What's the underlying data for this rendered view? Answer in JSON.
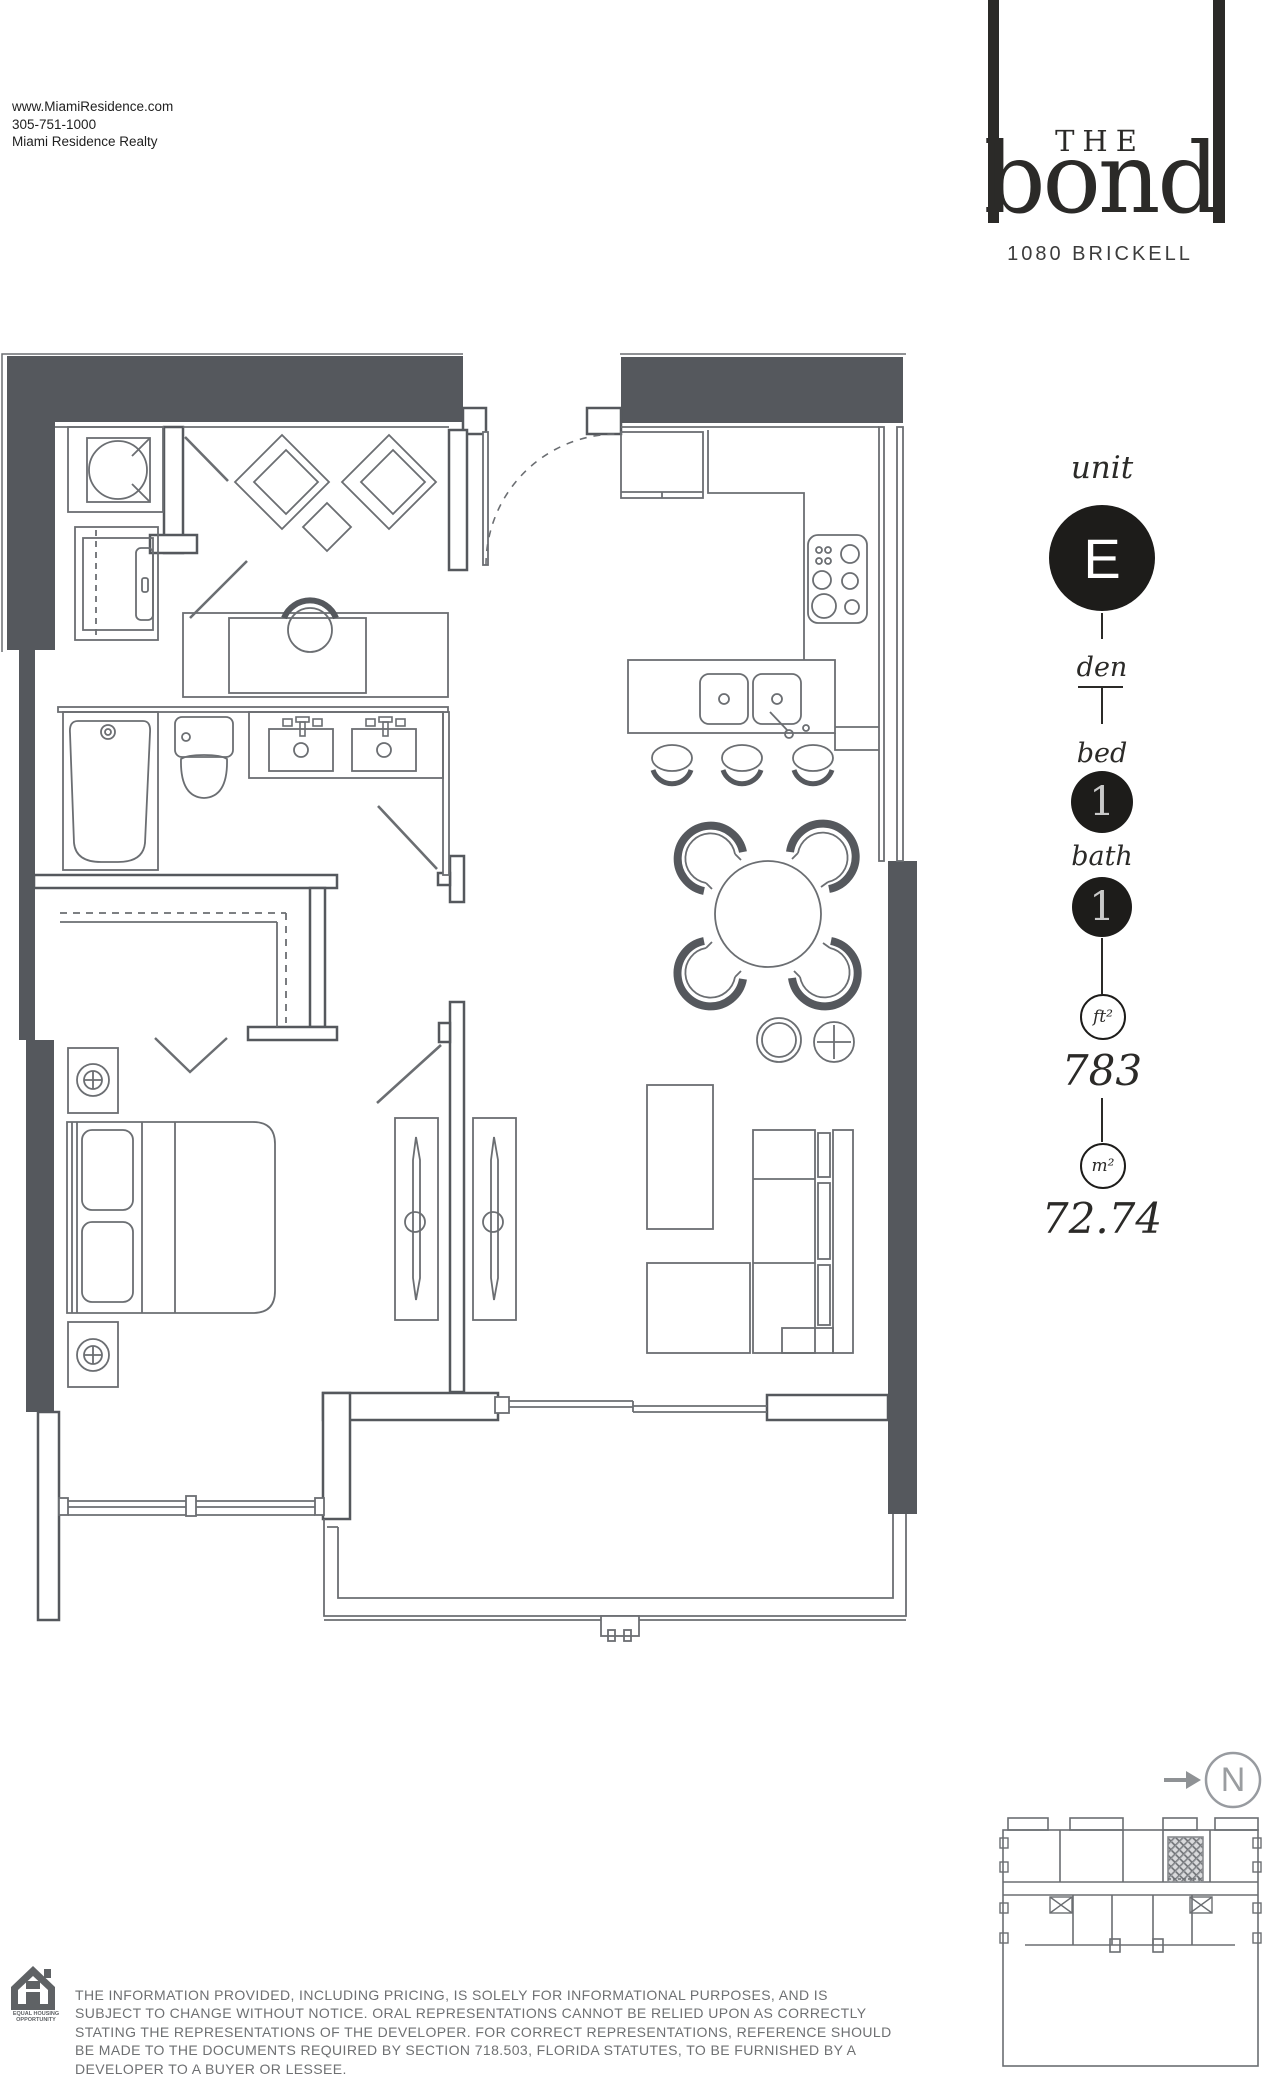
{
  "header": {
    "contact": "www.MiamiResidence.com\n305-751-1000\nMiami Residence Realty",
    "brand": {
      "the": "THE",
      "name": "bond",
      "address": "1080 BRICKELL"
    }
  },
  "unit_panel": {
    "unit_label": "unit",
    "unit_value": "E",
    "den_label": "den",
    "bed_label": "bed",
    "bed_value": "1",
    "bath_label": "bath",
    "bath_value": "1",
    "sqft_label": "ft²",
    "sqft_value": "783",
    "sqm_label": "m²",
    "sqm_value": "72.74",
    "accent_color": "#1d1c1a"
  },
  "compass": {
    "label": "N"
  },
  "floor_plan": {
    "wall_color": "#55585d",
    "line_color": "#6b6e72"
  },
  "footer": {
    "eho_label": "EQUAL HOUSING\nOPPORTUNITY",
    "disclaimer": "THE INFORMATION PROVIDED, INCLUDING PRICING, IS SOLELY FOR INFORMATIONAL PURPOSES, AND IS\nSUBJECT TO CHANGE WITHOUT NOTICE. ORAL REPRESENTATIONS CANNOT BE RELIED UPON AS CORRECTLY\nSTATING THE REPRESENTATIONS OF THE DEVELOPER. FOR CORRECT REPRESENTATIONS, REFERENCE SHOULD\nBE MADE TO THE DOCUMENTS REQUIRED BY SECTION 718.503, FLORIDA STATUTES, TO BE FURNISHED BY A\nDEVELOPER TO A BUYER OR LESSEE."
  }
}
